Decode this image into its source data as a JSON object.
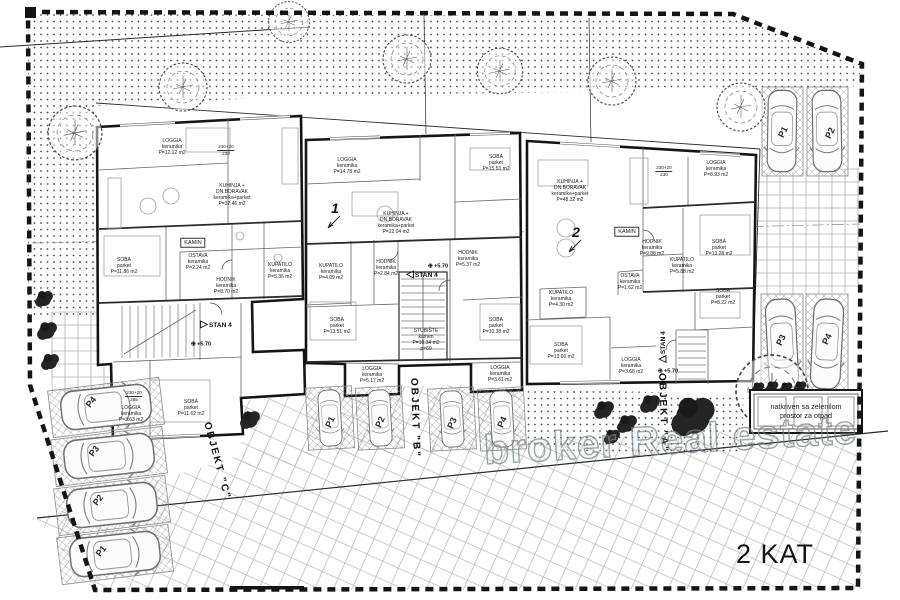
{
  "floor_label": "2 KAT",
  "watermark_text": "broker Real estate",
  "waste_area": {
    "line1": "natkriven sa zelenilom",
    "line2": "prostor za otpad"
  },
  "colors": {
    "wall": "#151515",
    "partition": "#666666",
    "pattern_gray": "#b5b5b5",
    "watermark_gray": "#7d878c"
  },
  "object_labels": [
    {
      "text": "OBJEKT \"C\"",
      "x": 217,
      "y": 461,
      "rot": 75
    },
    {
      "text": "OBJEKT \"B\"",
      "x": 415,
      "y": 418,
      "rot": 88
    },
    {
      "text": "OBJEKT \"A\"",
      "x": 663,
      "y": 413,
      "rot": 88
    }
  ],
  "stan_markers": [
    {
      "tri": "▷",
      "label": "STAN 4",
      "x": 216,
      "y": 325,
      "rot": 0
    },
    {
      "tri": "◁",
      "label": "STAN 4",
      "x": 422,
      "y": 275,
      "rot": 0
    },
    {
      "tri": "△",
      "label": "STAN 4",
      "x": 663,
      "y": 347,
      "rot": -90
    }
  ],
  "level_markers": [
    {
      "text": "+5.70",
      "x": 201,
      "y": 344
    },
    {
      "text": "+5.70",
      "x": 438,
      "y": 266
    },
    {
      "text": "+5.70",
      "x": 668,
      "y": 371
    }
  ],
  "entry_numbers": [
    {
      "text": "1",
      "x": 335,
      "y": 208
    },
    {
      "text": "2",
      "x": 576,
      "y": 232
    }
  ],
  "dimensions": [
    {
      "top": "230+20",
      "bottom": "230",
      "x": 226,
      "y": 150
    },
    {
      "top": "230+20",
      "bottom": "230",
      "x": 664,
      "y": 171
    },
    {
      "top": "230+20",
      "bottom": "285",
      "x": 134,
      "y": 396
    }
  ],
  "rooms": [
    {
      "lines": [
        "LOGGIA",
        "keramika",
        "P=12.12 m2"
      ],
      "x": 172,
      "y": 148
    },
    {
      "lines": [
        "KUHINJA +",
        "DN.BORAVAK",
        "keramika+parket",
        "P=37.46 m2"
      ],
      "x": 232,
      "y": 196
    },
    {
      "lines": [
        "SOBA",
        "parket",
        "P=11.86 m2"
      ],
      "x": 124,
      "y": 267
    },
    {
      "lines": [
        "OSTAVA",
        "keramika",
        "P=2.24 m2"
      ],
      "x": 198,
      "y": 263
    },
    {
      "lines": [
        "KAMIN"
      ],
      "x": 193,
      "y": 243,
      "boxed": true
    },
    {
      "lines": [
        "KUPATILO",
        "keramika",
        "P=5.36 m2"
      ],
      "x": 280,
      "y": 272
    },
    {
      "lines": [
        "HODNIK",
        "keramika",
        "P=8.70 m2"
      ],
      "x": 226,
      "y": 287
    },
    {
      "lines": [
        "SOBA",
        "parket",
        "P=11.62 m2"
      ],
      "x": 191,
      "y": 409
    },
    {
      "lines": [
        "LOGGIA",
        "keramika",
        "P=3.63 m2"
      ],
      "x": 131,
      "y": 415
    },
    {
      "lines": [
        "LOGGIA",
        "keramika",
        "P=14.78 m2"
      ],
      "x": 347,
      "y": 167
    },
    {
      "lines": [
        "SOBA",
        "parket",
        "P=15.53 m2"
      ],
      "x": 496,
      "y": 164
    },
    {
      "lines": [
        "KUHINJA +",
        "DN.BORAVAK",
        "keramika+parket",
        "P=22.04 m2"
      ],
      "x": 396,
      "y": 224
    },
    {
      "lines": [
        "KUPATILO",
        "keramika",
        "P=4.09 m2"
      ],
      "x": 331,
      "y": 273
    },
    {
      "lines": [
        "HODNIK",
        "keramika",
        "P=2.84 m2"
      ],
      "x": 386,
      "y": 269
    },
    {
      "lines": [
        "HODNIK",
        "keramika",
        "P=5.37 m2"
      ],
      "x": 468,
      "y": 260
    },
    {
      "lines": [
        "SOBA",
        "parket",
        "P=13.51 m2"
      ],
      "x": 337,
      "y": 327
    },
    {
      "lines": [
        "SOBA",
        "parket",
        "P=10.38 m2"
      ],
      "x": 496,
      "y": 327
    },
    {
      "lines": [
        "STUBIŠTE",
        "kamen",
        "P=10.34 m2",
        "p=60"
      ],
      "x": 426,
      "y": 341
    },
    {
      "lines": [
        "LOGGIA",
        "keramika",
        "P=5.17 m2"
      ],
      "x": 372,
      "y": 376
    },
    {
      "lines": [
        "LOGGIA",
        "keramika",
        "P=3.61 m2"
      ],
      "x": 500,
      "y": 375
    },
    {
      "lines": [
        "KUHINJA +",
        "DN.BORAVAK",
        "keramika+parket",
        "P=48.32 m2"
      ],
      "x": 570,
      "y": 192
    },
    {
      "lines": [
        "LOGGIA",
        "keramika",
        "P=8.93 m2"
      ],
      "x": 716,
      "y": 170
    },
    {
      "lines": [
        "KAMIN"
      ],
      "x": 627,
      "y": 232,
      "boxed": true
    },
    {
      "lines": [
        "HODNIK",
        "keramika",
        "P=9.88 m2"
      ],
      "x": 652,
      "y": 249
    },
    {
      "lines": [
        "SOBA",
        "parket",
        "P=13.28 m2"
      ],
      "x": 719,
      "y": 249
    },
    {
      "lines": [
        "OSTAVA",
        "keramika",
        "P=1.62 m2"
      ],
      "x": 630,
      "y": 283
    },
    {
      "lines": [
        "KUPATILO",
        "keramika",
        "P=5.88 m2"
      ],
      "x": 682,
      "y": 267
    },
    {
      "lines": [
        "SOBA",
        "parket",
        "P=8.22 m2"
      ],
      "x": 723,
      "y": 298
    },
    {
      "lines": [
        "KUPATILO",
        "keramika",
        "P=4.30 m2"
      ],
      "x": 561,
      "y": 300
    },
    {
      "lines": [
        "SOBA",
        "parket",
        "P=13.66 m2"
      ],
      "x": 561,
      "y": 352
    },
    {
      "lines": [
        "LOGGIA",
        "keramika",
        "P=3.68 m2"
      ],
      "x": 631,
      "y": 367
    }
  ],
  "parking": [
    {
      "label": "P4",
      "x": 91,
      "y": 402,
      "rot": -52
    },
    {
      "label": "P3",
      "x": 94,
      "y": 451,
      "rot": -52
    },
    {
      "label": "P2",
      "x": 98,
      "y": 500,
      "rot": -52
    },
    {
      "label": "P1",
      "x": 101,
      "y": 551,
      "rot": -52
    },
    {
      "label": "P1",
      "x": 330,
      "y": 422,
      "rot": -66
    },
    {
      "label": "P2",
      "x": 380,
      "y": 422,
      "rot": -66
    },
    {
      "label": "P3",
      "x": 452,
      "y": 423,
      "rot": -66
    },
    {
      "label": "P4",
      "x": 502,
      "y": 422,
      "rot": -66
    },
    {
      "label": "P1",
      "x": 783,
      "y": 132,
      "rot": -64
    },
    {
      "label": "P2",
      "x": 830,
      "y": 133,
      "rot": -64
    },
    {
      "label": "P3",
      "x": 781,
      "y": 340,
      "rot": -64
    },
    {
      "label": "P4",
      "x": 827,
      "y": 339,
      "rot": -64
    }
  ]
}
